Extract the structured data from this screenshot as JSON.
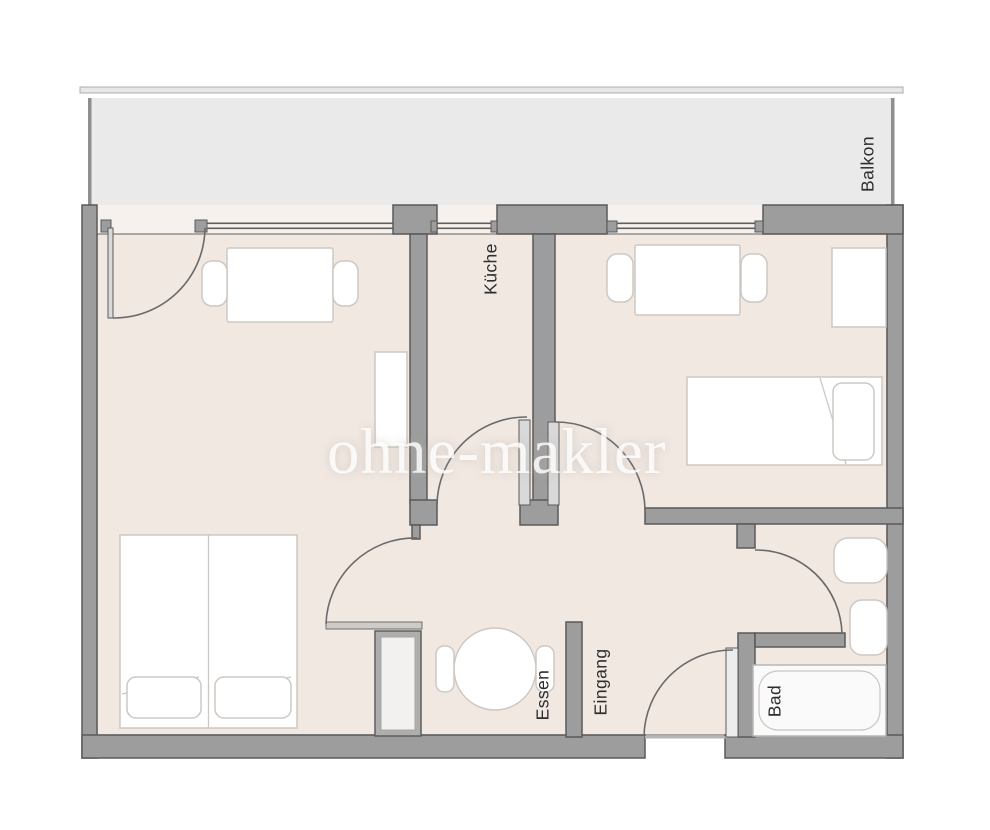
{
  "watermark": {
    "text": "ohne-makler",
    "logo": "house-and-key-icon"
  },
  "rooms": {
    "balkon": "Balkon",
    "kueche": "Küche",
    "essen": "Essen",
    "eingang": "Eingang",
    "bad": "Bad"
  },
  "furniture_icons": [
    "double-bed",
    "dining-table-with-two-chairs",
    "sideboard",
    "single-bed",
    "table-with-two-chairs",
    "wardrobe",
    "round-table-with-two-chairs",
    "tall-cabinet",
    "bathtub",
    "sink",
    "toilet"
  ],
  "colors": {
    "floor": "#f1e8e2",
    "balcony_floor": "#eaeaea",
    "wall": "#9d9d9d",
    "wall_outline": "#5a5a5a",
    "window_band": "#f6f1ed",
    "furniture_outline": "#cdc8c3",
    "door_arc": "#6a6a6a",
    "label_text": "#2e2e2e",
    "watermark": "#ffffff"
  }
}
